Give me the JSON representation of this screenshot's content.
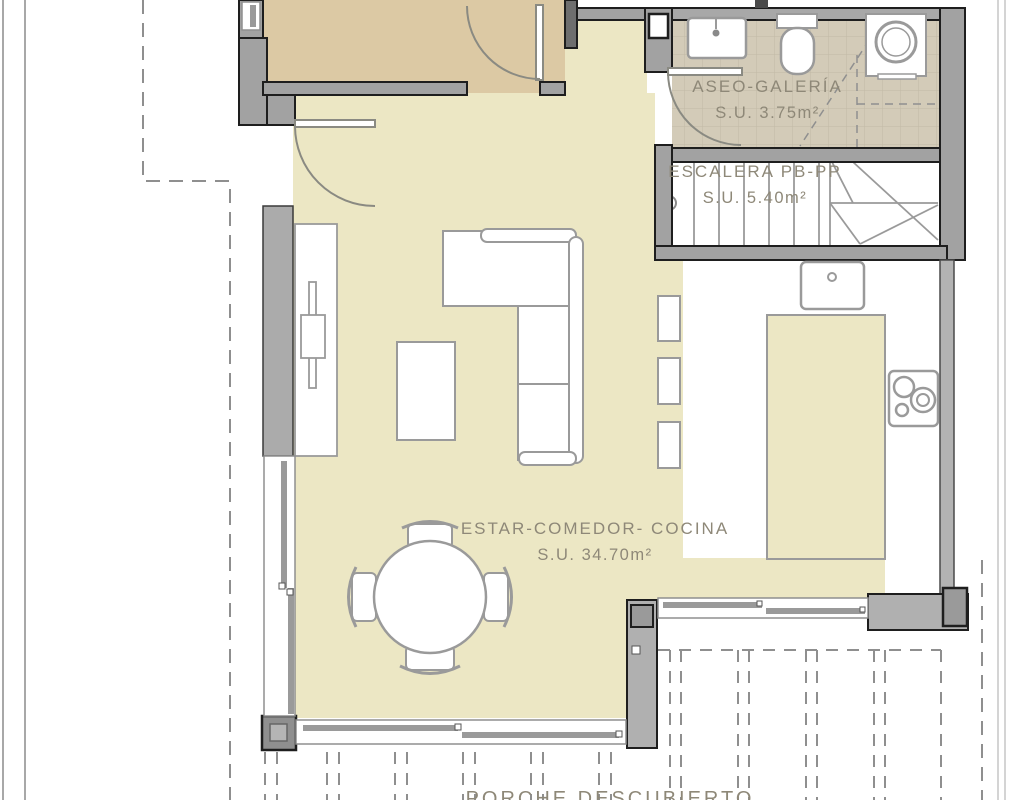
{
  "labels": {
    "aseo": {
      "name": "ASEO-GALERÍA",
      "area": "S.U. 3.75m²"
    },
    "escalera": {
      "name": "ESCALERA PB-PP",
      "area": "S.U. 5.40m²"
    },
    "estar": {
      "name": "ESTAR-COMEDOR- COCINA",
      "area": "S.U. 34.70m²"
    },
    "porche": {
      "name": "PORCHE DESCUBIERTO"
    }
  },
  "palette": {
    "background": "#ffffff",
    "floor_living": "#ece7c4",
    "floor_bedroom": "#dcc9a4",
    "floor_tile": "#d3cbb8",
    "tile_grid": "#c2baa6",
    "wall": "#a2a2a2",
    "wall_outline": "#1e1e1e",
    "furniture_outline": "#9a9a9a",
    "label_text": "#8e8878",
    "dashed_guides": "#8f8f8f"
  },
  "fixtures": [
    "bathroom-sink",
    "toilet",
    "washing-machine",
    "staircase",
    "kitchen-sink",
    "cooktop",
    "kitchen-island",
    "shelf-niche",
    "tv-unit",
    "coffee-table",
    "corner-sofa",
    "round-dining-table",
    "dining-chair",
    "hinged-door",
    "sliding-glass-door",
    "column",
    "pergola-beam-guides",
    "plot-boundary"
  ]
}
